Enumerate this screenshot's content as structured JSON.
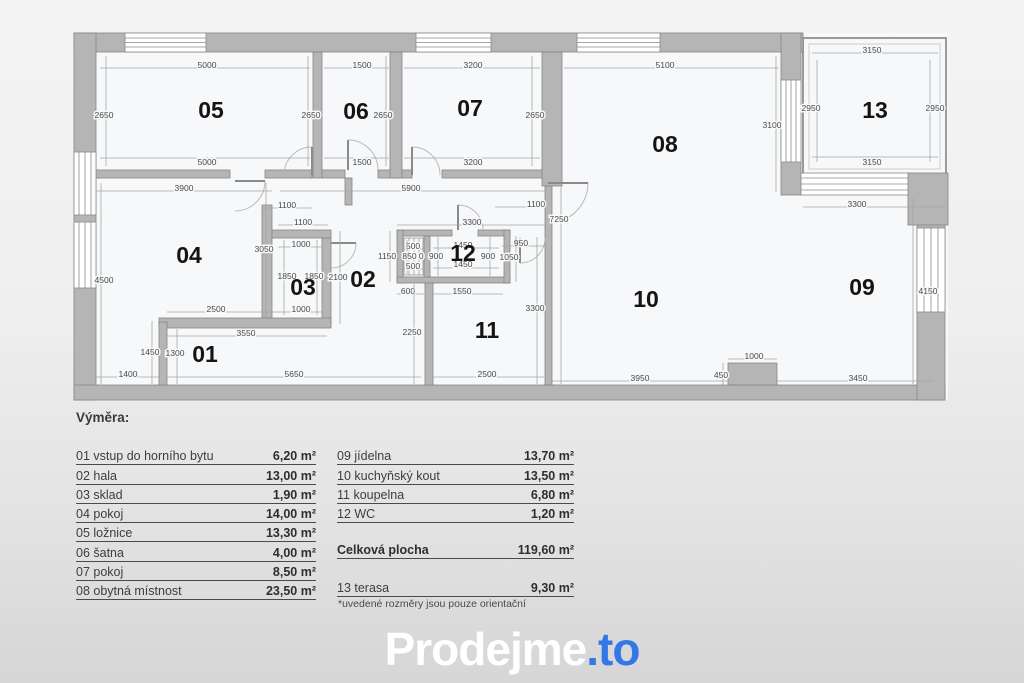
{
  "legend": {
    "header": "Výměra:",
    "left_rows": [
      {
        "label": "01 vstup do horního bytu",
        "value": "6,20 m²"
      },
      {
        "label": "02 hala",
        "value": "13,00 m²"
      },
      {
        "label": "03 sklad",
        "value": "1,90 m²"
      },
      {
        "label": "04 pokoj",
        "value": "14,00 m²"
      },
      {
        "label": "05 ložnice",
        "value": "13,30 m²"
      },
      {
        "label": "06 šatna",
        "value": "4,00 m²"
      },
      {
        "label": "07 pokoj",
        "value": "8,50 m²"
      },
      {
        "label": "08 obytná místnost",
        "value": "23,50 m²"
      }
    ],
    "right_rows": [
      {
        "label": "09 jídelna",
        "value": "13,70 m²"
      },
      {
        "label": "10 kuchyňský kout",
        "value": "13,50 m²"
      },
      {
        "label": "11 koupelna",
        "value": "6,80 m²"
      },
      {
        "label": "12 WC",
        "value": "1,20 m²"
      }
    ],
    "total": {
      "label": "Celková plocha",
      "value": "119,60 m²"
    },
    "terrace": {
      "label": "13 terasa",
      "value": "9,30 m²"
    },
    "footnote": "*uvedené rozměry jsou pouze orientační"
  },
  "logo": {
    "main": "Prodejme",
    "accent": ".to",
    "accent_color": "#3478e8"
  },
  "floorplan": {
    "colors": {
      "wall": "#b5b5b5",
      "outline": "#858585",
      "room": "#f7f8fa",
      "dim_line": "#a6a6a6",
      "dim_text": "#4a4a4a"
    },
    "room_labels": [
      {
        "t": "05",
        "x": 211,
        "y": 118
      },
      {
        "t": "06",
        "x": 356,
        "y": 119
      },
      {
        "t": "07",
        "x": 470,
        "y": 116
      },
      {
        "t": "08",
        "x": 665,
        "y": 152
      },
      {
        "t": "13",
        "x": 875,
        "y": 118
      },
      {
        "t": "04",
        "x": 189,
        "y": 263
      },
      {
        "t": "03",
        "x": 303,
        "y": 295
      },
      {
        "t": "02",
        "x": 363,
        "y": 287
      },
      {
        "t": "12",
        "x": 463,
        "y": 261
      },
      {
        "t": "11",
        "x": 487,
        "y": 338
      },
      {
        "t": "01",
        "x": 205,
        "y": 362
      },
      {
        "t": "10",
        "x": 646,
        "y": 307
      },
      {
        "t": "09",
        "x": 862,
        "y": 295
      }
    ],
    "dims": [
      {
        "t": "5000",
        "x": 207,
        "y": 65,
        "l": [
          100,
          68,
          310,
          68
        ]
      },
      {
        "t": "2650",
        "x": 104,
        "y": 115,
        "l": [
          106,
          56,
          106,
          166
        ]
      },
      {
        "t": "2650",
        "x": 311,
        "y": 115,
        "l": [
          308,
          56,
          308,
          166
        ]
      },
      {
        "t": "5000",
        "x": 207,
        "y": 162,
        "l": [
          100,
          158,
          310,
          158
        ]
      },
      {
        "t": "1500",
        "x": 362,
        "y": 65,
        "l": [
          324,
          68,
          389,
          68
        ]
      },
      {
        "t": "2650",
        "x": 383,
        "y": 115,
        "l": [
          386,
          56,
          386,
          166
        ]
      },
      {
        "t": "1500",
        "x": 362,
        "y": 162,
        "l": [
          324,
          158,
          389,
          158
        ]
      },
      {
        "t": "3200",
        "x": 473,
        "y": 65,
        "l": [
          404,
          68,
          540,
          68
        ]
      },
      {
        "t": "2650",
        "x": 535,
        "y": 115,
        "l": [
          532,
          56,
          532,
          166
        ]
      },
      {
        "t": "3200",
        "x": 473,
        "y": 162,
        "l": [
          404,
          158,
          540,
          158
        ]
      },
      {
        "t": "5100",
        "x": 665,
        "y": 65,
        "l": [
          564,
          68,
          779,
          68
        ]
      },
      {
        "t": "3100",
        "x": 772,
        "y": 125,
        "l": [
          776,
          56,
          776,
          192
        ]
      },
      {
        "t": "3150",
        "x": 872,
        "y": 50,
        "l": [
          812,
          53,
          938,
          53
        ]
      },
      {
        "t": "2950",
        "x": 811,
        "y": 108,
        "l": [
          817,
          60,
          817,
          162
        ]
      },
      {
        "t": "2950",
        "x": 935,
        "y": 108,
        "l": [
          930,
          60,
          930,
          162
        ]
      },
      {
        "t": "3150",
        "x": 872,
        "y": 162,
        "l": [
          812,
          157,
          938,
          157
        ]
      },
      {
        "t": "3300",
        "x": 857,
        "y": 204,
        "l": [
          803,
          207,
          945,
          207
        ]
      },
      {
        "t": "3900",
        "x": 184,
        "y": 188,
        "l": [
          96,
          191,
          272,
          191
        ]
      },
      {
        "t": "5900",
        "x": 411,
        "y": 188,
        "l": [
          280,
          191,
          545,
          191
        ]
      },
      {
        "t": "1100",
        "x": 287,
        "y": 205,
        "l": [
          262,
          208,
          312,
          208
        ]
      },
      {
        "t": "1100",
        "x": 536,
        "y": 204,
        "l": [
          495,
          207,
          545,
          207
        ]
      },
      {
        "t": "7250",
        "x": 559,
        "y": 219,
        "l": [
          561,
          185,
          561,
          384
        ]
      },
      {
        "t": "1100",
        "x": 303,
        "y": 222,
        "l": [
          278,
          225,
          328,
          225
        ]
      },
      {
        "t": "3300",
        "x": 472,
        "y": 222,
        "l": [
          397,
          225,
          545,
          225
        ]
      },
      {
        "t": "1000",
        "x": 301,
        "y": 244,
        "l": [
          278,
          247,
          323,
          247
        ]
      },
      {
        "t": "3050",
        "x": 264,
        "y": 249,
        "l": [
          266,
          183,
          266,
          317
        ]
      },
      {
        "t": "950",
        "x": 521,
        "y": 243,
        "l": [
          502,
          246,
          545,
          246
        ]
      },
      {
        "t": "4500",
        "x": 104,
        "y": 280,
        "l": [
          101,
          183,
          101,
          384
        ]
      },
      {
        "t": "1150",
        "x": 387,
        "y": 256,
        "l": [
          390,
          231,
          390,
          282
        ]
      },
      {
        "t": "500",
        "x": 413,
        "y": 246,
        "l": [
          404,
          249,
          424,
          249
        ]
      },
      {
        "t": "850 0",
        "x": 413,
        "y": 256,
        "l": [
          407,
          240,
          407,
          274
        ]
      },
      {
        "t": "500",
        "x": 413,
        "y": 266,
        "l": [
          404,
          269,
          424,
          269
        ]
      },
      {
        "t": "900",
        "x": 436,
        "y": 256,
        "l": [
          438,
          236,
          438,
          276
        ]
      },
      {
        "t": "1450",
        "x": 463,
        "y": 245,
        "l": [
          433,
          248,
          499,
          248
        ]
      },
      {
        "t": "1450",
        "x": 463,
        "y": 264,
        "l": [
          433,
          268,
          499,
          268
        ]
      },
      {
        "t": "900",
        "x": 488,
        "y": 256,
        "l": [
          490,
          236,
          490,
          276
        ]
      },
      {
        "t": "1050",
        "x": 509,
        "y": 257,
        "l": [
          516,
          236,
          516,
          282
        ]
      },
      {
        "t": "2100",
        "x": 338,
        "y": 277,
        "l": [
          340,
          231,
          340,
          324
        ]
      },
      {
        "t": "1850",
        "x": 287,
        "y": 276,
        "l": [
          284,
          240,
          284,
          315
        ]
      },
      {
        "t": "1850",
        "x": 314,
        "y": 276,
        "l": [
          317,
          240,
          317,
          315
        ]
      },
      {
        "t": "2500",
        "x": 216,
        "y": 309,
        "l": [
          167,
          312,
          279,
          312
        ]
      },
      {
        "t": "1000",
        "x": 301,
        "y": 309,
        "l": [
          278,
          312,
          323,
          312
        ]
      },
      {
        "t": "3550",
        "x": 246,
        "y": 333,
        "l": [
          167,
          336,
          327,
          336
        ]
      },
      {
        "t": "1450",
        "x": 150,
        "y": 352,
        "l": [
          152,
          321,
          152,
          384
        ]
      },
      {
        "t": "1300",
        "x": 175,
        "y": 353,
        "l": [
          177,
          329,
          177,
          384
        ]
      },
      {
        "t": "1400",
        "x": 128,
        "y": 374,
        "l": [
          96,
          377,
          159,
          377
        ]
      },
      {
        "t": "5650",
        "x": 294,
        "y": 374,
        "l": [
          167,
          377,
          421,
          377
        ]
      },
      {
        "t": "600",
        "x": 408,
        "y": 291,
        "l": [
          397,
          294,
          424,
          294
        ]
      },
      {
        "t": "1550",
        "x": 462,
        "y": 291,
        "l": [
          433,
          294,
          503,
          294
        ]
      },
      {
        "t": "2250",
        "x": 412,
        "y": 332,
        "l": [
          414,
          284,
          414,
          384
        ]
      },
      {
        "t": "3300",
        "x": 535,
        "y": 308,
        "l": [
          537,
          237,
          537,
          384
        ]
      },
      {
        "t": "2500",
        "x": 487,
        "y": 374,
        "l": [
          433,
          377,
          544,
          377
        ]
      },
      {
        "t": "3950",
        "x": 640,
        "y": 378,
        "l": [
          552,
          381,
          728,
          381
        ]
      },
      {
        "t": "450",
        "x": 721,
        "y": 375,
        "l": [
          723,
          363,
          723,
          385
        ]
      },
      {
        "t": "1000",
        "x": 754,
        "y": 356,
        "l": [
          728,
          359,
          777,
          359
        ]
      },
      {
        "t": "3450",
        "x": 858,
        "y": 378,
        "l": [
          777,
          381,
          932,
          381
        ]
      },
      {
        "t": "4150",
        "x": 928,
        "y": 291,
        "l": [
          913,
          198,
          913,
          384
        ]
      }
    ]
  }
}
